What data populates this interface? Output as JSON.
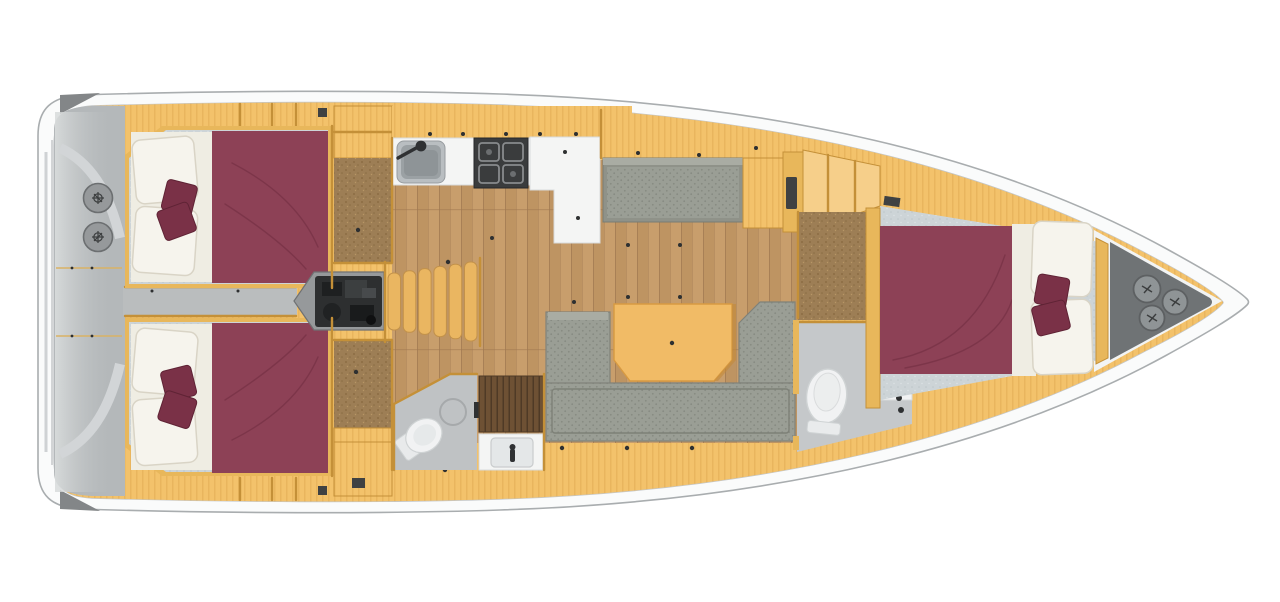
{
  "meta": {
    "description": "Top-down interior floor plan of a sailing yacht: two aft double cabins, twin helm cockpit, galley with sink and stove, chart table, saloon with U-shaped sofa and table, two heads with toilet and basin, companionway steps over engine, forward double cabin and bow locker with three hatches",
    "view": "plan-top"
  },
  "features": {
    "helm_wheels": 2,
    "bow_hatches": 3,
    "companionway_steps": 6,
    "aft_cabins": 2,
    "forward_cabins": 1,
    "heads": 2,
    "saloon_tables": 1,
    "throw_pillows_per_bed": 2
  },
  "palette": {
    "hull_fill": "#fafbfb",
    "hull_stroke": "#a9adaf",
    "hull_inner_line": "#c3c6c8",
    "deck_wedge": "#838688",
    "platform_line": "#cfd2d4",
    "cockpit": "#b4b8ba",
    "cockpit_light": "#d8dbdc",
    "cockpit_arc": "#d2d5d7",
    "walkway": "#babdbe",
    "wheel": "#96999b",
    "wheel_rim": "#6c6f71",
    "wheel_glyph": "#3b3d3e",
    "cabinet": "#f3c26b",
    "cabinet_stripe": "#d9a149",
    "cabinet_light": "#f6cf8a",
    "wall": "#c49038",
    "wall_wood": "#e8b75b",
    "wood_floor": "#c89e6c",
    "wood_floor_alt": "#bc9260",
    "wood_seam": "#a07850",
    "corridor": "#9d7e55",
    "corridor_dark": "#86683f",
    "bed": "#8d4156",
    "bed_crease": "#6f2c40",
    "bed_sheet": "#efede3",
    "pillow_white": "#f6f4ed",
    "pillow_edge": "#d9d4c6",
    "throw_pillow": "#7a3147",
    "throw_pillow_edge": "#5f2335",
    "mattress": "#cdd4d7",
    "sofa": "#9a9e95",
    "sofa_dot": "#878b82",
    "sofa_dark": "#7e8178",
    "sofa_top": "#a9ac a3",
    "table": "#f1bb66",
    "table_edge": "#d79a42",
    "stairs": "#eab661",
    "stairs_edge": "#c3924a",
    "engine_box": "#96999b",
    "engine_edge": "#6f7173",
    "engine_body": "#2d2f30",
    "stove": "#3a3c3d",
    "stove_metal": "#888b8d",
    "sink_rim": "#b9bec1",
    "sink_steel": "#9ba1a4",
    "sink_deep": "#8a9093",
    "counter_white": "#f4f5f4",
    "counter_edge": "#d8dadb",
    "fixture_white": "#f1f2f3",
    "fixture_edge": "#cfd3d4",
    "head_floor": "#c5c8ca",
    "head_floor2": "#bfc2c4",
    "teak": "#6e5134",
    "teak_line": "#4f3a26",
    "bow_deck": "#6f7375",
    "hatch": "#8f9496",
    "hatch_rim": "#5d6062",
    "dark_dot": "#2e3031",
    "vent": "#3f4142",
    "white_area": "#f2f4f4",
    "faucet": "#2f3133"
  }
}
